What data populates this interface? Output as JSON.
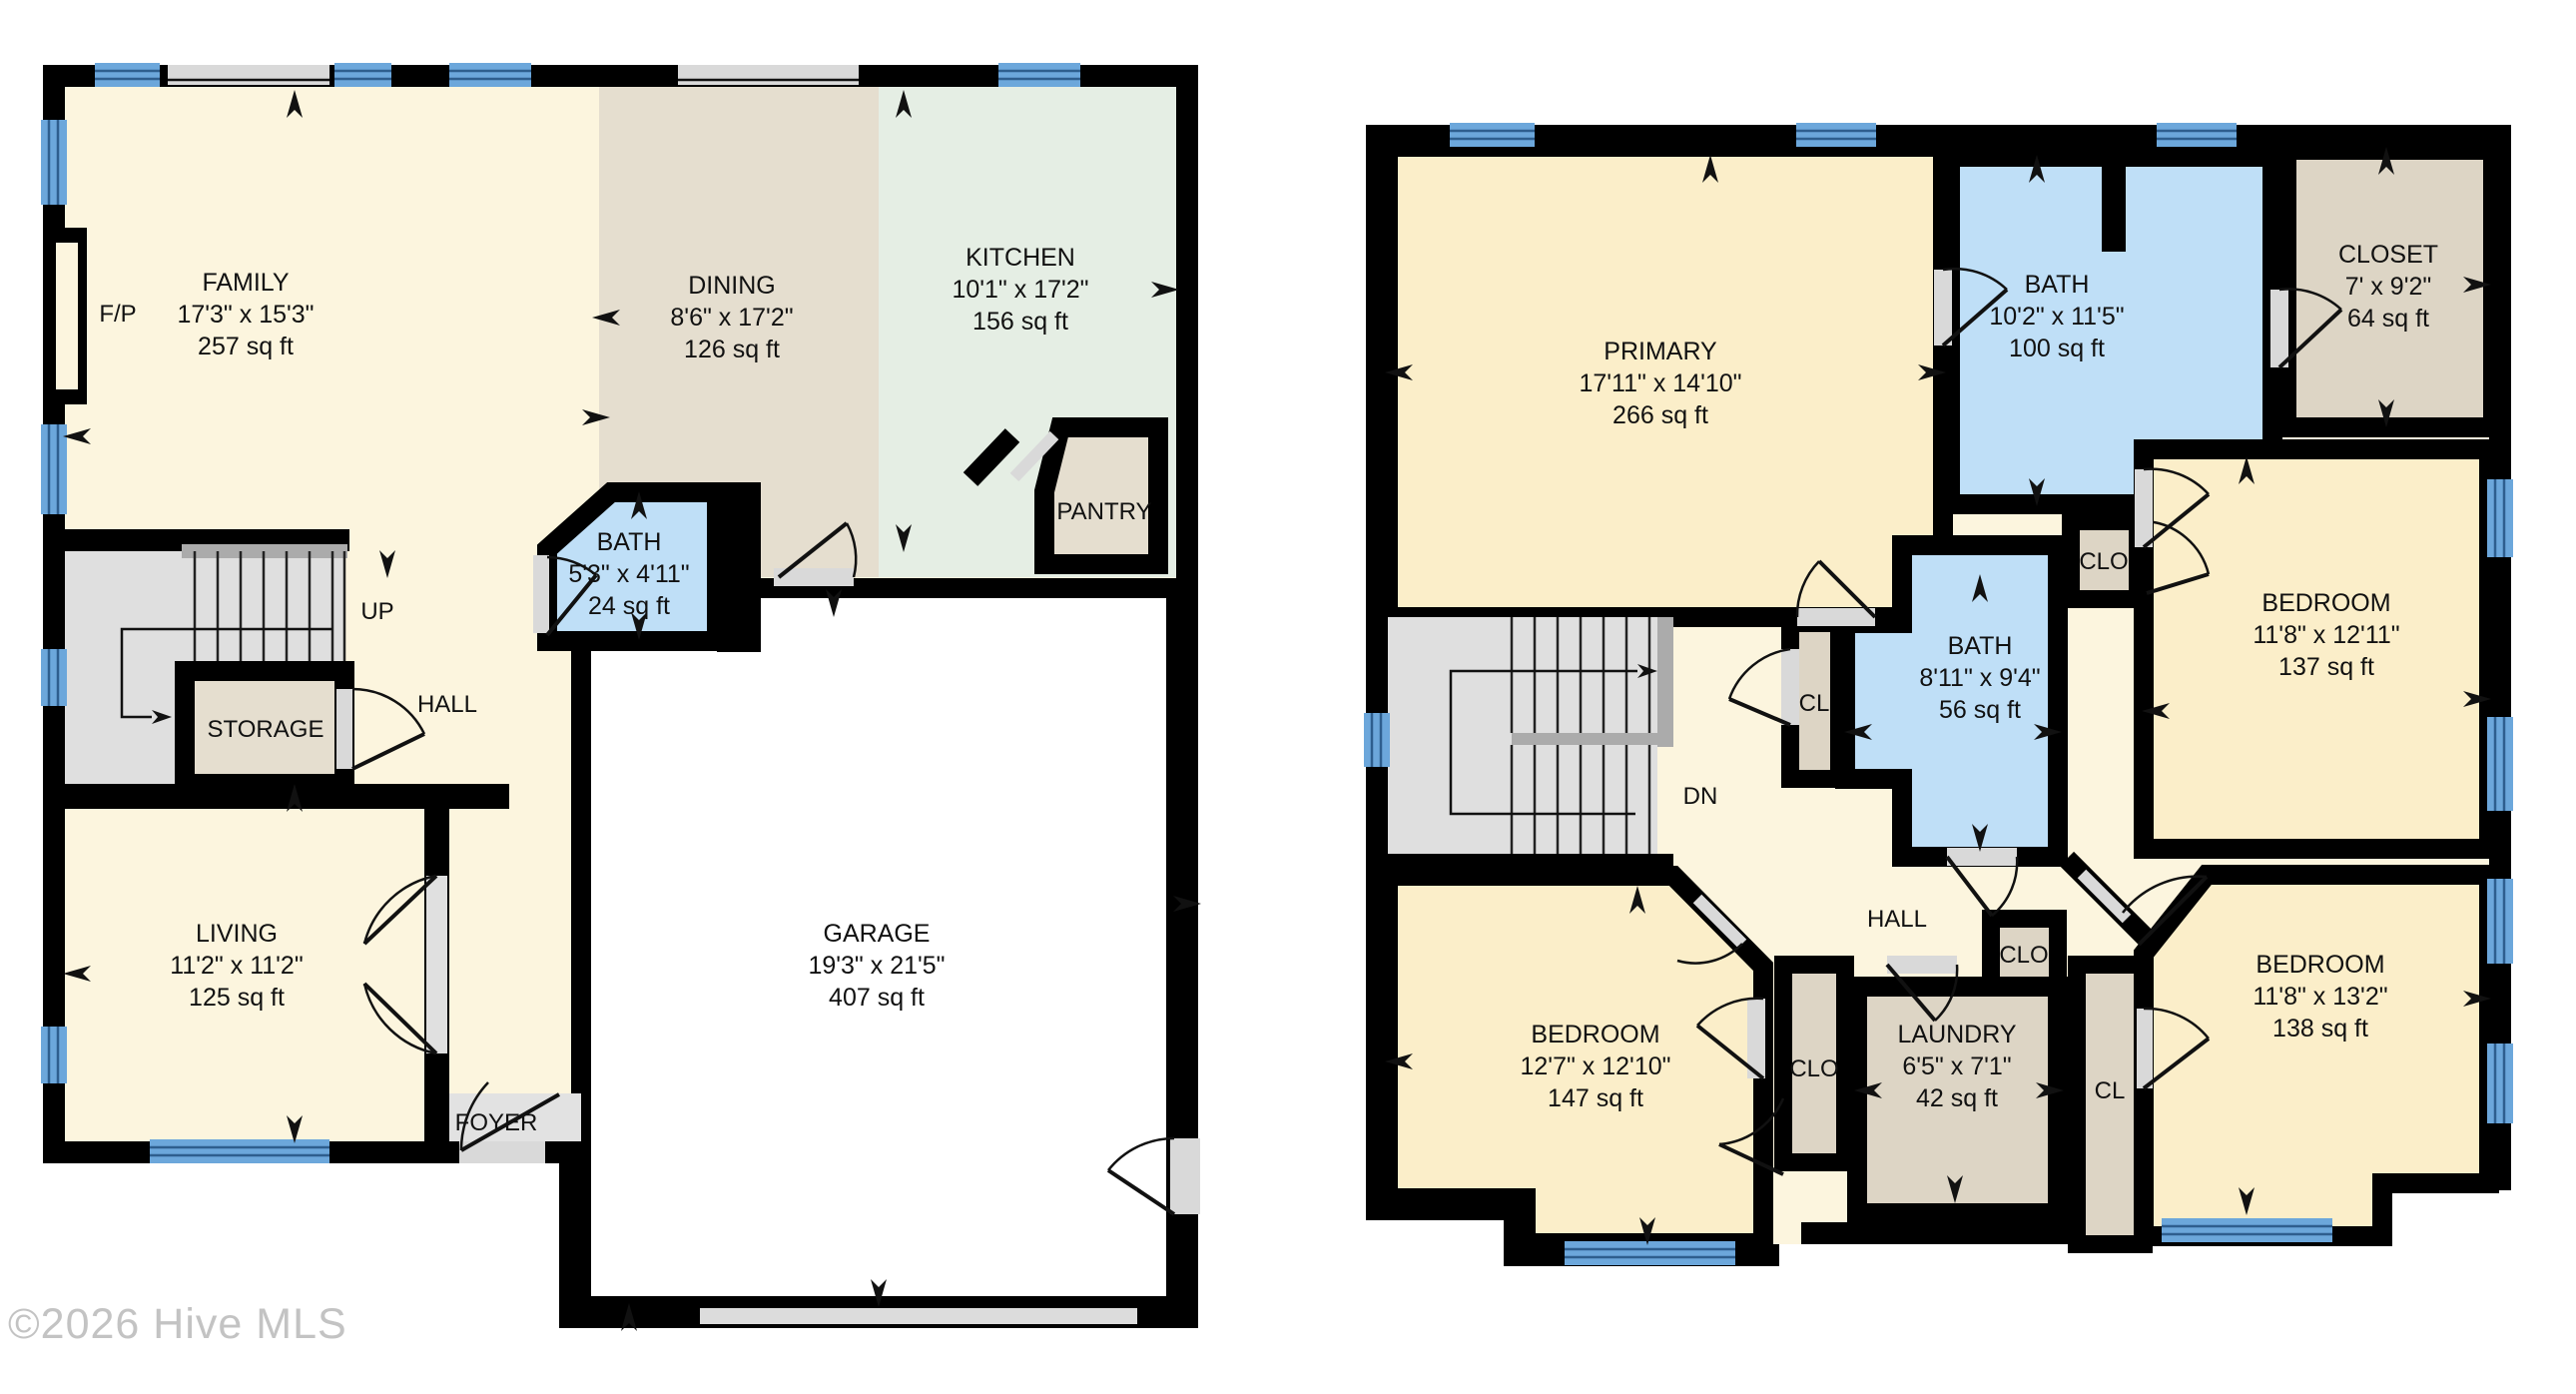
{
  "watermark": "©2026 Hive MLS",
  "colors": {
    "wall": "#000000",
    "first_floor_cream": "#FCF5DE",
    "second_floor_cream": "#FBEEC9",
    "dining_tan": "#E5DECF",
    "closet_tan": "#DDD5C5",
    "kitchen_green": "#E5EEE4",
    "bath_blue": "#BFDFF7",
    "stair_gray": "#DFDFDF",
    "entry_gray": "#E2E2E2",
    "window_blue": "#6CA7DB",
    "door_gray": "#D9D9D9",
    "garage_white": "#FFFFFF",
    "watermark_gray": "#C3C3C3"
  },
  "floor1": {
    "family": {
      "name": "FAMILY",
      "dims": "17'3\" x 15'3\"",
      "area": "257 sq ft"
    },
    "dining": {
      "name": "DINING",
      "dims": "8'6\" x 17'2\"",
      "area": "126 sq ft"
    },
    "kitchen": {
      "name": "KITCHEN",
      "dims": "10'1\" x 17'2\"",
      "area": "156 sq ft"
    },
    "bath": {
      "name": "BATH",
      "dims": "5'3\" x 4'11\"",
      "area": "24 sq ft"
    },
    "living": {
      "name": "LIVING",
      "dims": "11'2\" x 11'2\"",
      "area": "125 sq ft"
    },
    "garage": {
      "name": "GARAGE",
      "dims": "19'3\" x 21'5\"",
      "area": "407 sq ft"
    },
    "labels": {
      "fireplace": "F/P",
      "up": "UP",
      "hall": "HALL",
      "storage": "STORAGE",
      "pantry": "PANTRY",
      "foyer": "FOYER"
    }
  },
  "floor2": {
    "primary": {
      "name": "PRIMARY",
      "dims": "17'11\" x 14'10\"",
      "area": "266 sq ft"
    },
    "bath1": {
      "name": "BATH",
      "dims": "10'2\" x 11'5\"",
      "area": "100 sq ft"
    },
    "closet": {
      "name": "CLOSET",
      "dims": "7' x 9'2\"",
      "area": "64 sq ft"
    },
    "bedroom1": {
      "name": "BEDROOM",
      "dims": "11'8\" x 12'11\"",
      "area": "137 sq ft"
    },
    "bath2": {
      "name": "BATH",
      "dims": "8'11\" x 9'4\"",
      "area": "56 sq ft"
    },
    "bedroom2": {
      "name": "BEDROOM",
      "dims": "12'7\" x 12'10\"",
      "area": "147 sq ft"
    },
    "laundry": {
      "name": "LAUNDRY",
      "dims": "6'5\" x 7'1\"",
      "area": "42 sq ft"
    },
    "bedroom3": {
      "name": "BEDROOM",
      "dims": "11'8\" x 13'2\"",
      "area": "138 sq ft"
    },
    "labels": {
      "dn": "DN",
      "hall": "HALL",
      "cl_hall": "CL",
      "clo_bath": "CLO",
      "clo_bedroom2": "CLO",
      "clo_laundry": "CLO",
      "cl_laundry": "CL"
    }
  }
}
